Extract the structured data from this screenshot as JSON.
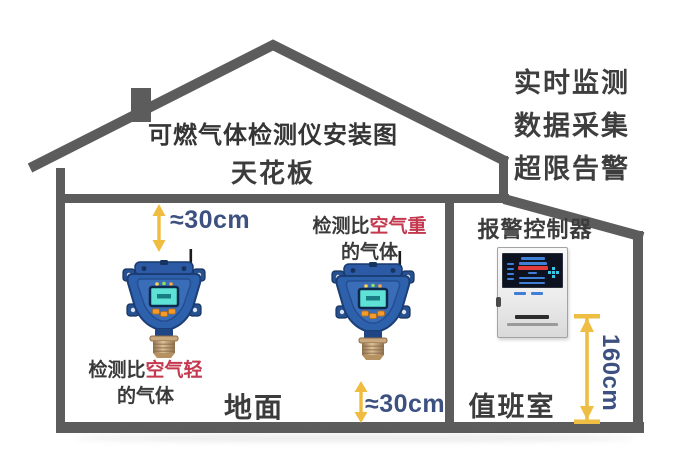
{
  "title": "可燃气体检测仪安装图",
  "house": {
    "ceiling_label": "天花板",
    "ground_label": "地面",
    "duty_room_label": "值班室"
  },
  "features": [
    "实时监测",
    "数据采集",
    "超限告警"
  ],
  "measurements": {
    "ceiling_gap": "≈30cm",
    "floor_gap": "≈30cm",
    "controller_height": "160cm"
  },
  "annotations": {
    "heavy_gas": {
      "prefix": "检测比",
      "highlight": "空气重",
      "suffix": "的气体"
    },
    "light_gas": {
      "prefix": "检测比",
      "highlight": "空气轻",
      "suffix": "的气体"
    },
    "controller_label": "报警控制器"
  },
  "devices": {
    "left_detector": "gas-detector",
    "right_detector": "gas-detector",
    "controller": "alarm-controller"
  },
  "colors": {
    "structure_gray": "#5c5c5c",
    "measure_blue": "#3d5181",
    "highlight_red": "#c4394f",
    "arrow_yellow": "#efbc3f",
    "detector_blue": "#2e61ac",
    "screen_teal": "#5fe2d6",
    "button_orange": "#f59b2c",
    "sensor_bronze": "#b69162"
  }
}
